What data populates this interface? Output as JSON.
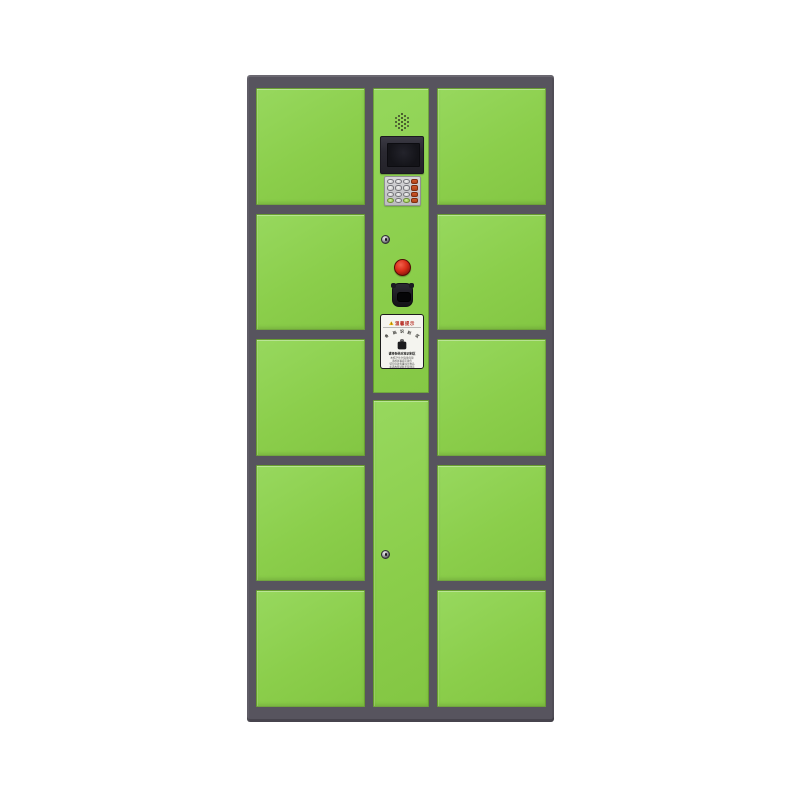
{
  "meta": {
    "description": "Green 10-compartment smart parcel locker cabinet with central control console on white background",
    "background": "#ffffff"
  },
  "colors": {
    "frame": "#57545e",
    "door_green": "#8cd04f",
    "button_red": "#d2301f",
    "keypad_orange": "#c24a1d",
    "keypad_green": "#9ccc4e",
    "screen_bezel": "#2a2931",
    "label_bg": "#f4f4ef"
  },
  "layout": {
    "left_doors": 5,
    "right_doors": 5,
    "center_doors": 1
  },
  "control_panel": {
    "devices": [
      "speaker",
      "display-screen",
      "keypad",
      "cam-lock",
      "call-button",
      "barcode-scanner",
      "notice-label"
    ],
    "keypad": {
      "rows": 4,
      "cols": 4,
      "keys": [
        [
          "gray",
          "gray",
          "gray",
          "orange"
        ],
        [
          "gray",
          "gray",
          "gray",
          "orange"
        ],
        [
          "gray",
          "gray",
          "gray",
          "orange"
        ],
        [
          "green",
          "gray",
          "green",
          "orange"
        ]
      ]
    }
  },
  "label": {
    "title": "温馨提示",
    "arc_text": "条码识别区",
    "bold_line": "请将条码对准识别区",
    "fine_print": [
      "本柜24小时自助存取",
      "请按屏幕提示操作",
      "切勿存放贵重违禁物品",
      "如遇故障请联系管理员"
    ]
  }
}
